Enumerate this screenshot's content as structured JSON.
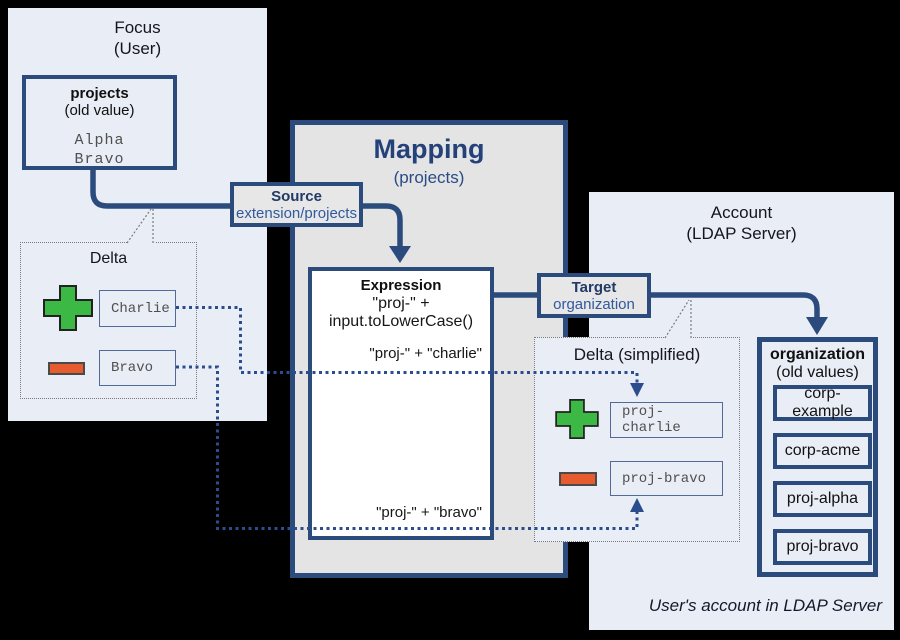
{
  "colors": {
    "background": "#000000",
    "panel_bg": "#e9edf6",
    "mapping_bg": "#e4e4e4",
    "box_border_blue": "#2a4b7c",
    "title_blue": "#24417a",
    "label_dark_blue": "#213a66",
    "label_medium_blue": "#30599f",
    "dotted_line_blue": "#2b4d8e",
    "delta_border_gray": "#7a7a7a",
    "mono_text_gray": "#4f4f4f",
    "add_green": "#3cb844",
    "remove_orange": "#e65c2e",
    "expression_bg": "#ffffff"
  },
  "focus_panel": {
    "title_line1": "Focus",
    "title_line2": "(User)",
    "attribute_box": {
      "name": "projects",
      "qualifier": "(old value)",
      "values": [
        "Alpha",
        "Bravo"
      ]
    },
    "delta": {
      "title": "Delta",
      "add_value": "Charlie",
      "remove_value": "Bravo"
    }
  },
  "mapping": {
    "title": "Mapping",
    "subtitle": "(projects)",
    "source": {
      "label": "Source",
      "path": "extension/projects"
    },
    "expression": {
      "label": "Expression",
      "code": "\"proj-\" + input.toLowerCase()",
      "result_add": "\"proj-\" + \"charlie\"",
      "result_remove": "\"proj-\" + \"bravo\""
    },
    "target": {
      "label": "Target",
      "path": "organization"
    }
  },
  "account_panel": {
    "title_line1": "Account",
    "title_line2": "(LDAP Server)",
    "delta": {
      "title": "Delta (simplified)",
      "add_value": "proj-charlie",
      "remove_value": "proj-bravo"
    },
    "attribute_box": {
      "name": "organization",
      "qualifier": "(old values)",
      "values": [
        "corp-example",
        "corp-acme",
        "proj-alpha",
        "proj-bravo"
      ]
    },
    "caption": "User's account in LDAP Server"
  }
}
